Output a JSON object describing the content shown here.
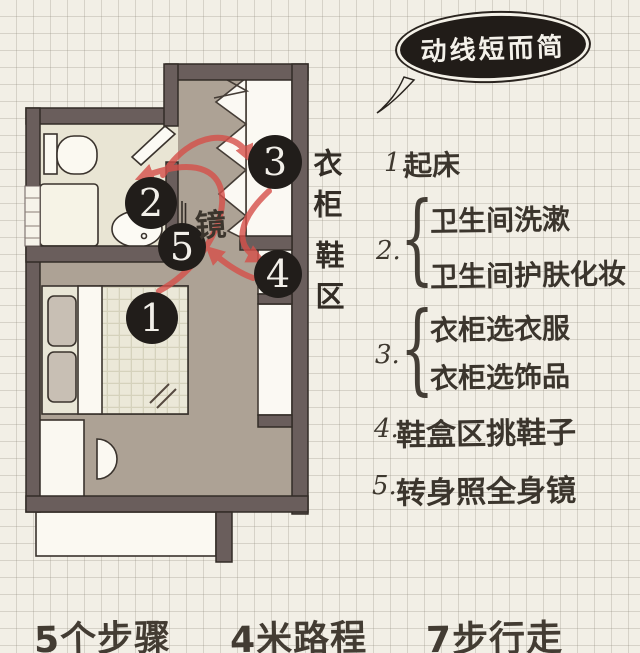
{
  "colors": {
    "paper": "#f2efe6",
    "grid_line": "#d2cfc4",
    "wall": "#6a5e5c",
    "floor_corridor": "#ada295",
    "floor_bathroom": "#e9e5d4",
    "route_red": "#d6504a",
    "marker_black": "#211d1a",
    "ink": "#3b352d"
  },
  "bubble": {
    "text": "动线短而简"
  },
  "plan": {
    "mirror_label": "镜",
    "side_labels": {
      "wardrobe": "衣柜",
      "shoe": "鞋区"
    },
    "markers": [
      {
        "n": "1"
      },
      {
        "n": "2"
      },
      {
        "n": "3"
      },
      {
        "n": "4"
      },
      {
        "n": "5"
      }
    ]
  },
  "steps": [
    {
      "num": "1.",
      "lines": [
        "起床"
      ]
    },
    {
      "num": "2.",
      "brace": "{",
      "lines": [
        "卫生间洗漱",
        "卫生间护肤化妆"
      ]
    },
    {
      "num": "3.",
      "brace": "{",
      "lines": [
        "衣柜选衣服",
        "衣柜选饰品"
      ]
    },
    {
      "num": "4.",
      "lines": [
        "鞋盒区挑鞋子"
      ]
    },
    {
      "num": "5.",
      "lines": [
        "转身照全身镜"
      ]
    }
  ],
  "footer": {
    "items": [
      "5个步骤",
      "4米路程",
      "7步行走"
    ]
  }
}
